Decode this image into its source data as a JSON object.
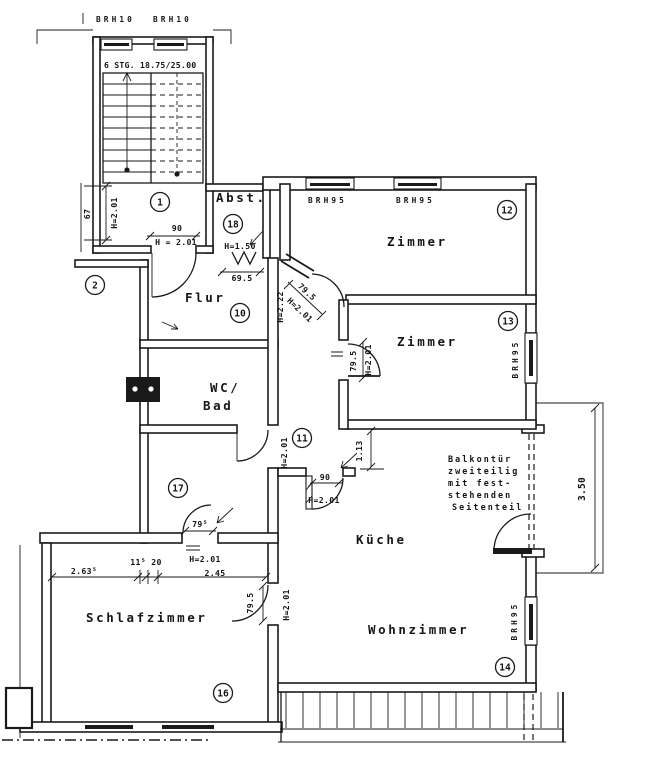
{
  "plan": {
    "windows": {
      "stair_left": "BRH10",
      "stair_right": "BRH10",
      "zimmer_ne_1": "BRH95",
      "zimmer_ne_2": "BRH95",
      "zimmer_se": "BRH95",
      "wohnzimmer": "BRH95"
    },
    "rooms": {
      "stairwell": {
        "number": "1",
        "stairs_note": "6 STG. 18.75/25.00"
      },
      "neighbor": {
        "number": "2"
      },
      "flur": {
        "number": "10",
        "label": "Flur"
      },
      "corridor": {
        "number": "11"
      },
      "zimmer_ne": {
        "number": "12",
        "label": "Zimmer"
      },
      "zimmer_se": {
        "number": "13",
        "label": "Zimmer"
      },
      "wohnzimmer": {
        "number": "14",
        "label": "Wohnzimmer"
      },
      "schlafzimmer": {
        "number": "16",
        "label": "Schlafzimmer"
      },
      "flur_sued": {
        "number": "17"
      },
      "abstellraum": {
        "number": "18",
        "label": "Abst."
      },
      "wc_bad": {
        "line1": "WC/",
        "line2": "Bad"
      },
      "kueche": {
        "label": "Küche"
      }
    },
    "dims": {
      "entry_width": "90",
      "entry_height": "H = 2.01",
      "stair_win_width": "67",
      "stair_win_height": "H=2.01",
      "abst_height": "H=1.50",
      "abst_width": "69.5",
      "flur_height": "H=2.22",
      "flur_door_width": "79.5",
      "flur_door_height": "H=2.01",
      "z13_door_width": "79.5",
      "z13_door_height": "H=2.01",
      "wc_door_height": "H=2.01",
      "pier_113": "1.13",
      "kueche_door_width": "90",
      "kueche_door_height": "H=2.01",
      "balcony_depth": "3.50",
      "schlaf_seg1": "2.63⁵",
      "schlaf_seg2": "11⁵ 20",
      "schlaf_door_height": "H=2.01",
      "schlaf_seg3": "2.45",
      "s17_door_width": "79⁵",
      "schlaf_east_width": "79.5",
      "schlaf_east_height": "H=2.01"
    },
    "note": {
      "l1": "Balkontür",
      "l2": "zweiteilig",
      "l3": "mit fest-",
      "l4": "stehenden",
      "l5": "Seitenteil"
    }
  }
}
